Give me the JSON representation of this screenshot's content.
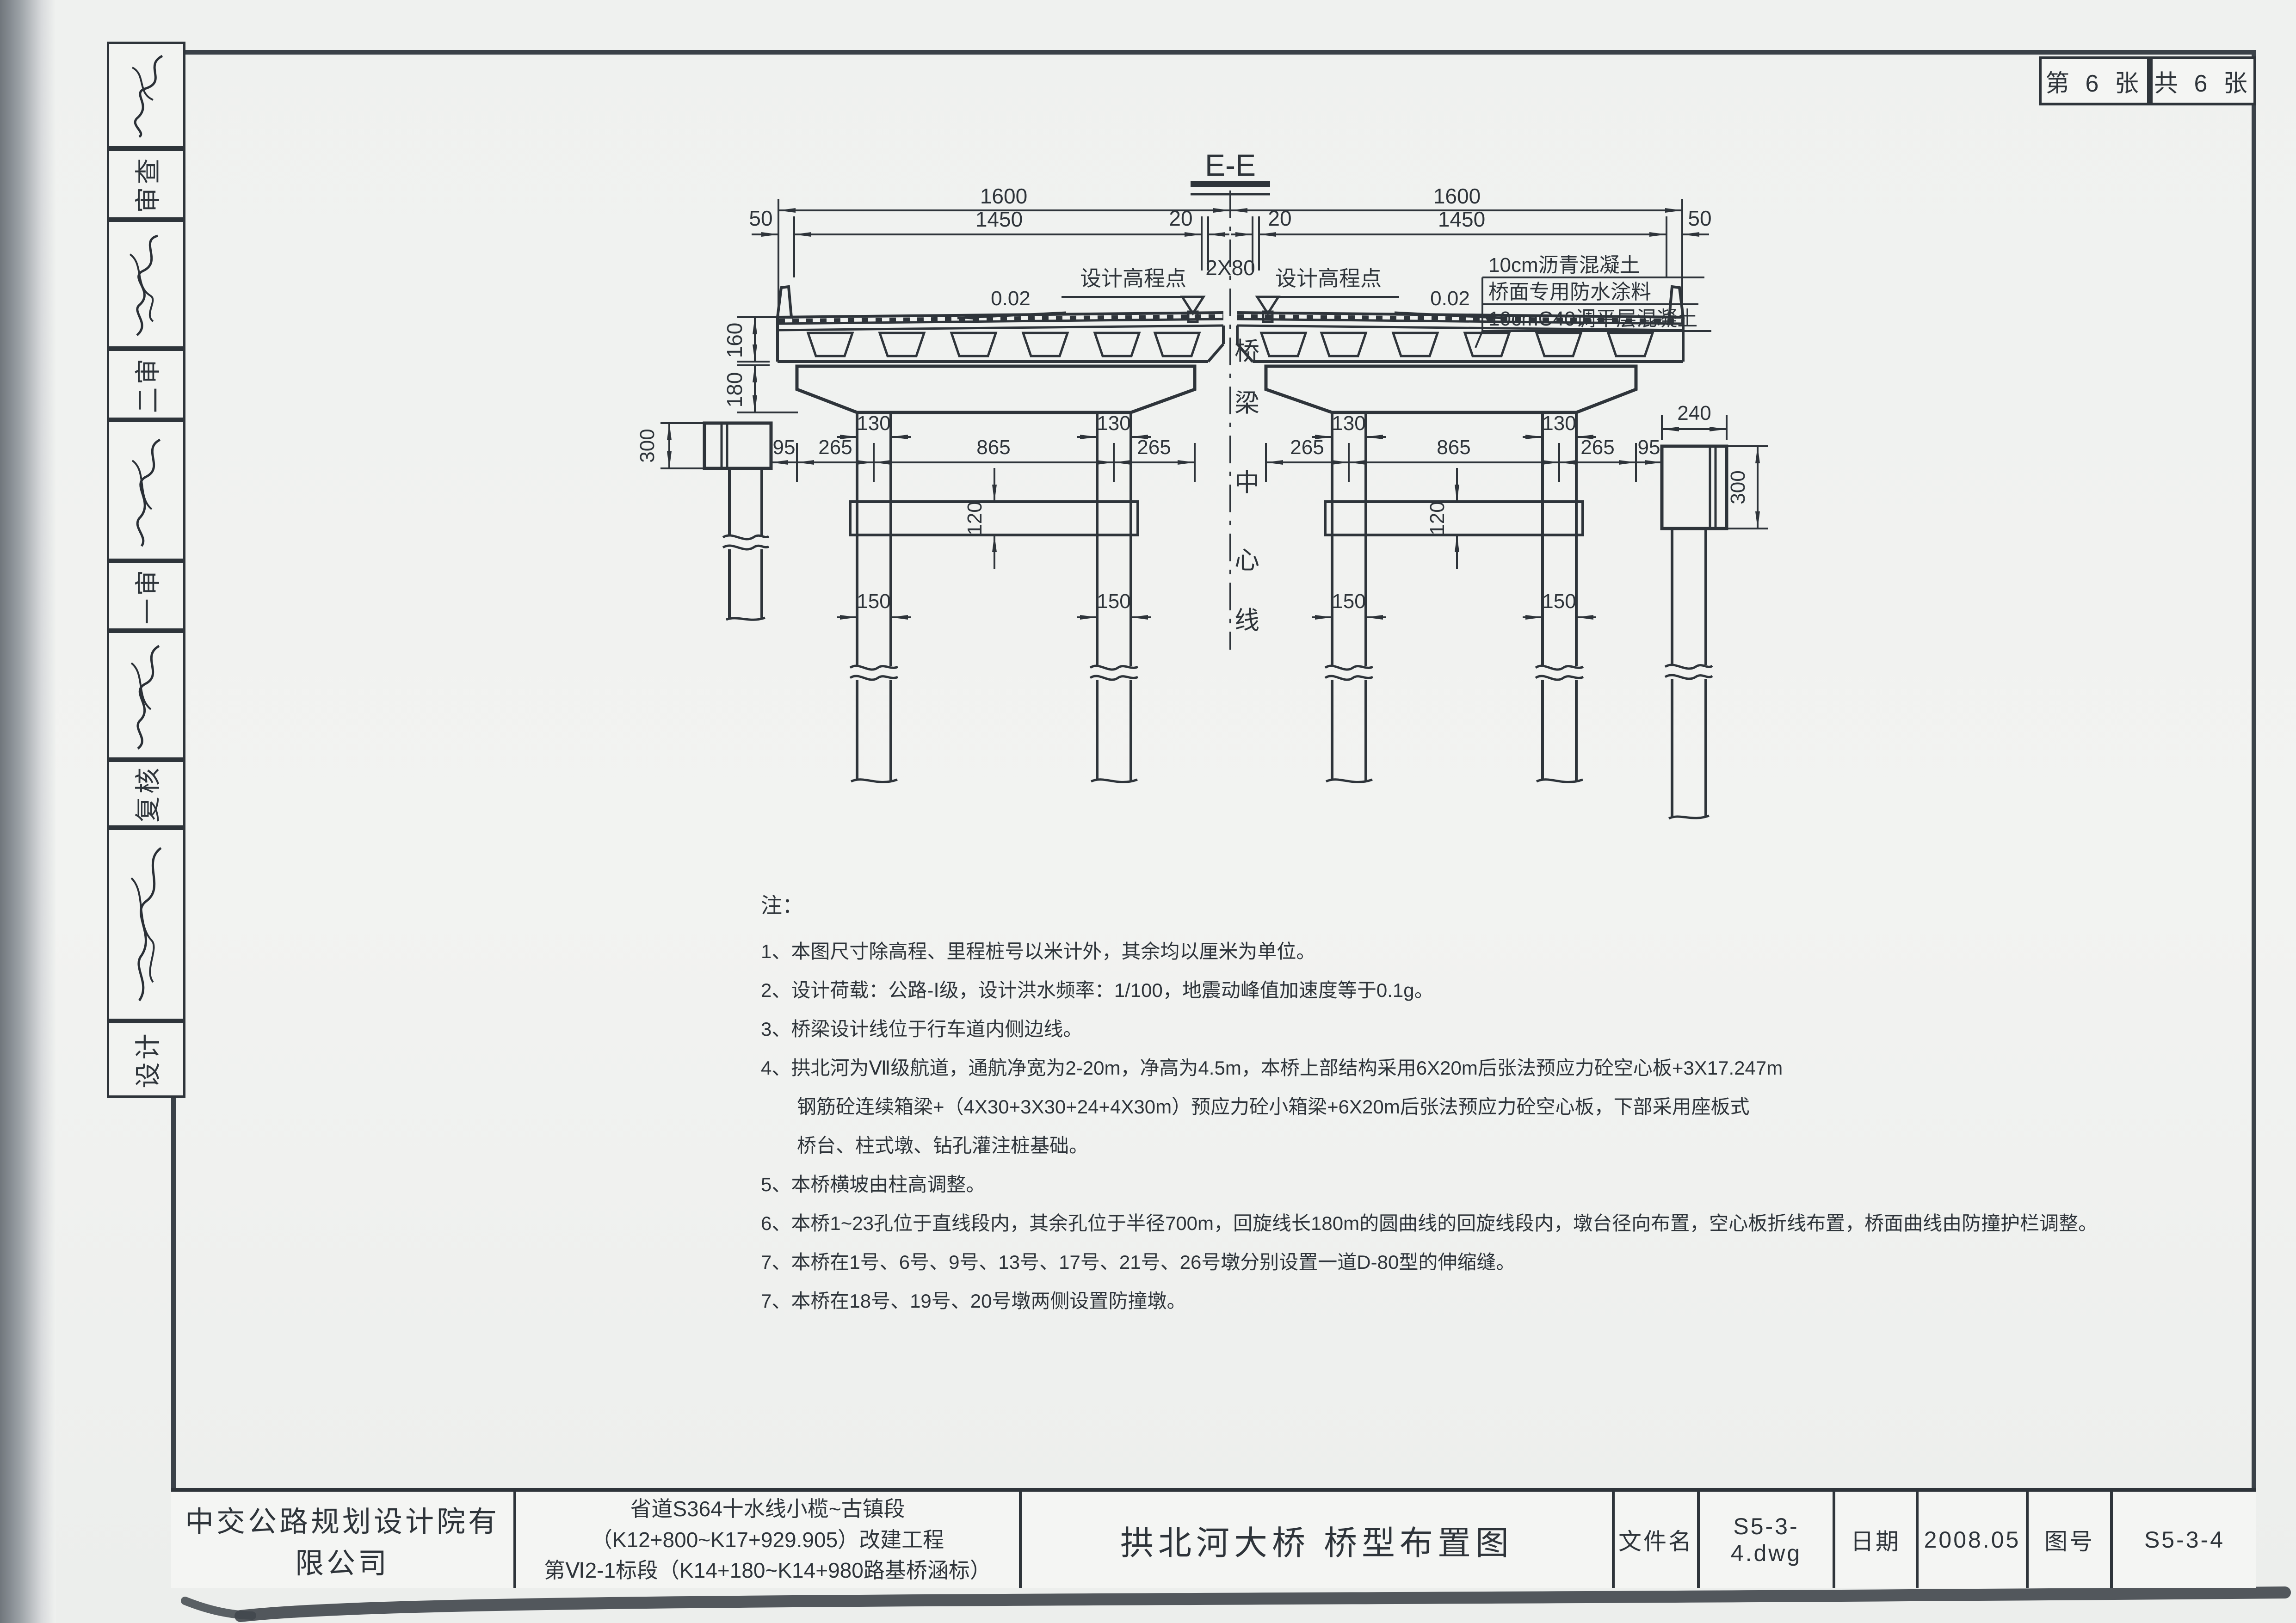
{
  "sheet_corner": {
    "current": "第 6 张",
    "total": "共 6 张"
  },
  "margin": {
    "labels": [
      "审查",
      "二审",
      "一审",
      "复核",
      "设计"
    ]
  },
  "drawing": {
    "section_title": "E-E",
    "centerline_text": "桥梁中心线",
    "centerline_chars": [
      "桥",
      "梁",
      "中",
      "心",
      "线"
    ],
    "design_point_label": "设计高程点",
    "slope_label": "0.02",
    "center_gap_label": "2X80",
    "pavement_layers": [
      "10cm沥青混凝土",
      "桥面专用防水涂料",
      "10cmC40调平层混凝土"
    ],
    "dims": {
      "d50": "50",
      "d1600": "1600",
      "d1450": "1450",
      "d20": "20",
      "d160": "160",
      "d180": "180",
      "d130": "130",
      "d265": "265",
      "d865": "865",
      "d95": "95",
      "d120": "120",
      "d150": "150",
      "d300": "300",
      "d240": "240"
    }
  },
  "notes": {
    "header": "注：",
    "lines": [
      "1、本图尺寸除高程、里程桩号以米计外，其余均以厘米为单位。",
      "2、设计荷载：公路-Ⅰ级，设计洪水频率：1/100，地震动峰值加速度等于0.1g。",
      "3、桥梁设计线位于行车道内侧边线。",
      "4、拱北河为Ⅶ级航道，通航净宽为2-20m，净高为4.5m，本桥上部结构采用6X20m后张法预应力砼空心板+3X17.247m",
      "钢筋砼连续箱梁+（4X30+3X30+24+4X30m）预应力砼小箱梁+6X20m后张法预应力砼空心板，下部采用座板式",
      "桥台、柱式墩、钻孔灌注桩基础。",
      "5、本桥横坡由柱高调整。",
      "6、本桥1~23孔位于直线段内，其余孔位于半径700m，回旋线长180m的圆曲线的回旋线段内，墩台径向布置，空心板折线布置，桥面曲线由防撞护栏调整。",
      "7、本桥在1号、6号、9号、13号、17号、21号、26号墩分别设置一道D-80型的伸缩缝。",
      "7、本桥在18号、19号、20号墩两侧设置防撞墩。"
    ]
  },
  "title_block": {
    "company": "中交公路规划设计院有限公司",
    "project_line1": "省道S364十水线小榄~古镇段（K12+800~K17+929.905）改建工程",
    "project_line2": "第Ⅵ2-1标段（K14+180~K14+980路基桥涵标）",
    "drawing_title": "拱北河大桥  桥型布置图",
    "file_label": "文件名",
    "file_value": "S5-3-4.dwg",
    "date_label": "日期",
    "date_value": "2008.05",
    "no_label": "图号",
    "no_value": "S5-3-4"
  }
}
